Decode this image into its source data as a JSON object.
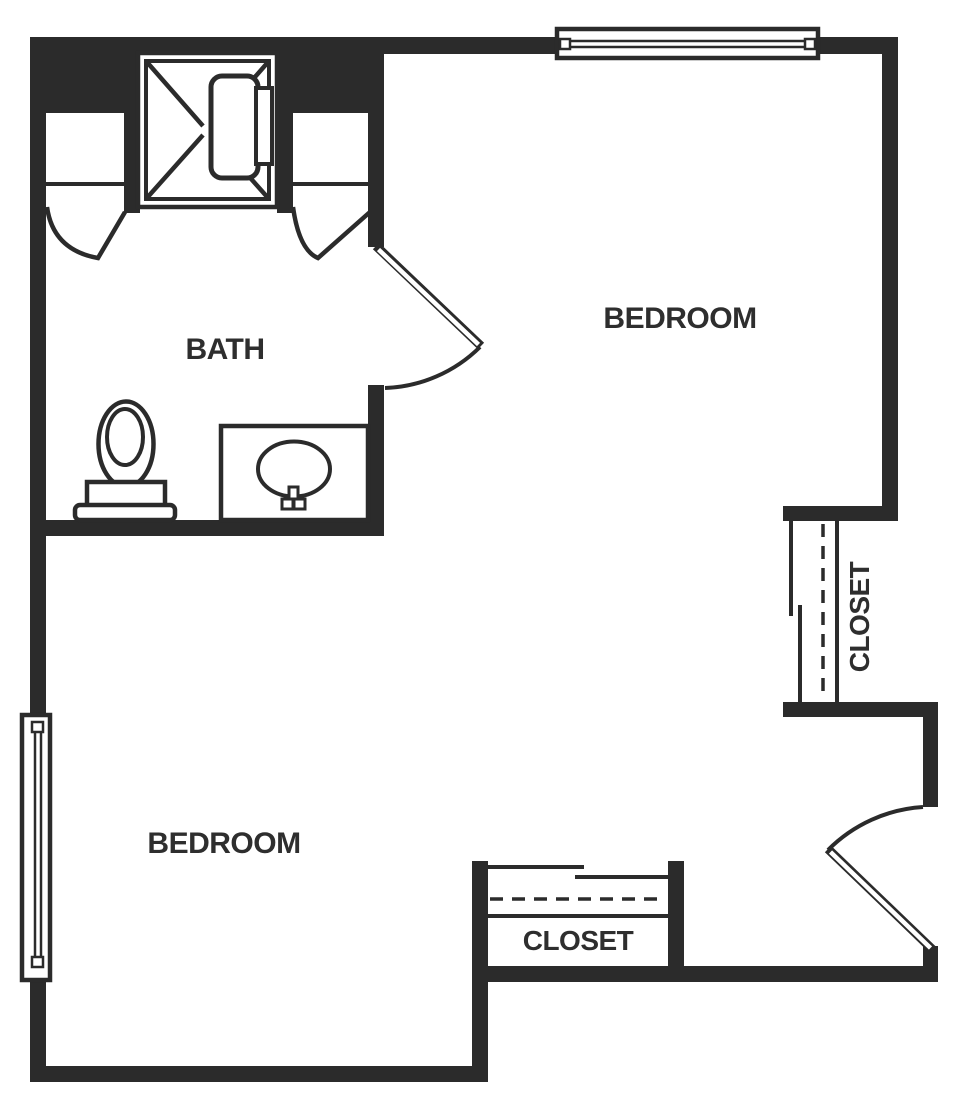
{
  "plan": {
    "title": "two-bedroom-bath-floor-plan",
    "colors": {
      "background": "#ffffff",
      "wall": "#2b2b2b",
      "label": "#2e2e2e"
    },
    "rooms": {
      "bath": {
        "label": "BATH"
      },
      "bedroom_top": {
        "label": "BEDROOM"
      },
      "bedroom_bottom": {
        "label": "BEDROOM"
      },
      "closet_right": {
        "label": "CLOSET"
      },
      "closet_bottom": {
        "label": "CLOSET"
      }
    },
    "fixtures": [
      "shower-stall",
      "shower-door",
      "toilet",
      "vanity-counter",
      "sink-basin",
      "faucet",
      "window-top",
      "window-left",
      "bath-swing-door",
      "entry-swing-door",
      "alcove-door-left",
      "alcove-door-right",
      "closet-rod-dashed-right",
      "closet-shelf-right",
      "sliding-doors-right",
      "closet-rod-dashed-bottom",
      "closet-shelf-bottom",
      "sliding-doors-bottom"
    ]
  }
}
